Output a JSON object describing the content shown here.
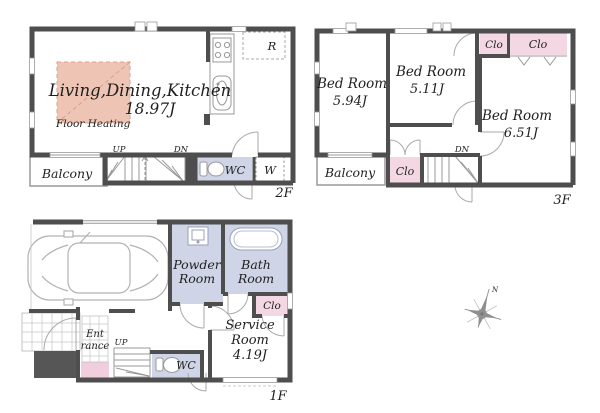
{
  "colors": {
    "wall": "#4e4e4e",
    "room_lavender": "#cfd4e6",
    "closet_pink": "#f3d7e3",
    "entrance_pink": "#f0cede",
    "floor_heating_fill": "#eec4b4",
    "floor_heating_border": "#d9a18d",
    "outline_gray": "#999999",
    "text": "#1f1f1f"
  },
  "floor2f": {
    "floor_label": "2F",
    "ldk_name": "Living,Dining,Kitchen",
    "ldk_size": "18.97J",
    "floor_heating": "Floor Heating",
    "balcony": "Balcony",
    "up": "UP",
    "dn": "DN",
    "wc": "WC",
    "washer": "W",
    "fridge": "R"
  },
  "floor3f": {
    "floor_label": "3F",
    "bedroom_left": "Bed Room",
    "bedroom_left_size": "5.94J",
    "bedroom_mid": "Bed Room",
    "bedroom_mid_size": "5.11J",
    "bedroom_right": "Bed Room",
    "bedroom_right_size": "6.51J",
    "closet_top_small": "Clo",
    "closet_top_wide": "Clo",
    "closet_hall": "Clo",
    "balcony": "Balcony",
    "dn": "DN"
  },
  "floor1f": {
    "floor_label": "1F",
    "powder_1": "Powder",
    "powder_2": "Room",
    "bath_1": "Bath",
    "bath_2": "Room",
    "closet": "Clo",
    "service_1": "Service",
    "service_2": "Room",
    "service_size": "4.19J",
    "entrance_1": "Ent",
    "entrance_2": "rance",
    "up": "UP",
    "wc": "WC"
  },
  "compass": {
    "north": "N"
  }
}
